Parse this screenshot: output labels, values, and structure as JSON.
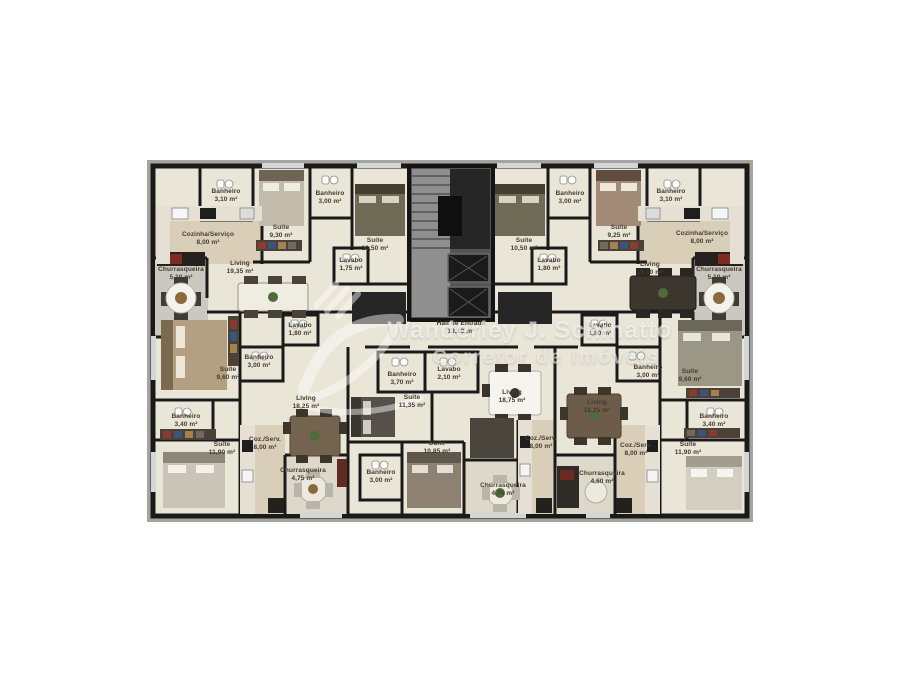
{
  "watermark": {
    "line1": "Wanderley J. Schinatto",
    "line2": "Corretor de Imóveis"
  },
  "hall": {
    "name": "Hall de Entrada",
    "area": "13,10 m²"
  },
  "apartments": [
    {
      "id": "top-left",
      "rooms": [
        {
          "name": "Banheiro",
          "area": "3,10 m²"
        },
        {
          "name": "Cozinha/Serviço",
          "area": "8,00 m²"
        },
        {
          "name": "Suíte",
          "area": "9,30 m²"
        },
        {
          "name": "Banheiro",
          "area": "3,00 m²"
        },
        {
          "name": "Suíte",
          "area": "10,50 m²"
        },
        {
          "name": "Lavabo",
          "area": "1,75 m²"
        },
        {
          "name": "Churrasqueira",
          "area": "5,10 m²"
        },
        {
          "name": "Living",
          "area": "19,35 m²"
        }
      ]
    },
    {
      "id": "top-right",
      "rooms": [
        {
          "name": "Banheiro",
          "area": "3,00 m²"
        },
        {
          "name": "Suíte",
          "area": "9,25 m²"
        },
        {
          "name": "Banheiro",
          "area": "3,10 m²"
        },
        {
          "name": "Suíte",
          "area": "10,50 m²"
        },
        {
          "name": "Lavabo",
          "area": "1,80 m²"
        },
        {
          "name": "Cozinha/Serviço",
          "area": "8,00 m²"
        },
        {
          "name": "Living",
          "area": "19,10 m²"
        },
        {
          "name": "Churrasqueira",
          "area": "5,10 m²"
        }
      ]
    },
    {
      "id": "bottom-left",
      "rooms": [
        {
          "name": "Lavabo",
          "area": "1,80 m²"
        },
        {
          "name": "Banheiro",
          "area": "3,00 m²"
        },
        {
          "name": "Suíte",
          "area": "9,60 m²"
        },
        {
          "name": "Living",
          "area": "18,25 m²"
        },
        {
          "name": "Banheiro",
          "area": "3,40 m²"
        },
        {
          "name": "Suíte",
          "area": "11,90 m²"
        },
        {
          "name": "Coz./Serv.",
          "area": "8,00 m²"
        },
        {
          "name": "Churrasqueira",
          "area": "4,75 m²"
        }
      ]
    },
    {
      "id": "bottom-center",
      "rooms": [
        {
          "name": "Banheiro",
          "area": "3,70 m²"
        },
        {
          "name": "Lavabo",
          "area": "2,10 m²"
        },
        {
          "name": "Suíte",
          "area": "11,35 m²"
        },
        {
          "name": "Living",
          "area": "18,75 m²"
        },
        {
          "name": "Suíte",
          "area": "10,85 m²"
        },
        {
          "name": "Coz./Serv.",
          "area": "8,00 m²"
        },
        {
          "name": "Banheiro",
          "area": "3,00 m²"
        },
        {
          "name": "Churrasqueira",
          "area": "4,75 m²"
        }
      ]
    },
    {
      "id": "bottom-right",
      "rooms": [
        {
          "name": "Lavabo",
          "area": "1,80 m²"
        },
        {
          "name": "Banheiro",
          "area": "3,00 m²"
        },
        {
          "name": "Suíte",
          "area": "9,60 m²"
        },
        {
          "name": "Living",
          "area": "18,25 m²"
        },
        {
          "name": "Banheiro",
          "area": "3,40 m²"
        },
        {
          "name": "Coz./Serv.",
          "area": "8,00 m²"
        },
        {
          "name": "Suíte",
          "area": "11,90 m²"
        },
        {
          "name": "Churrasqueira",
          "area": "4,60 m²"
        }
      ]
    }
  ],
  "colors": {
    "wall": "#1a1a1a",
    "floor": "#e9e5d7",
    "tile": "#d9cfb8",
    "terrace": "#cbc8c0",
    "slab": "#a6a49e",
    "core": "#555555"
  }
}
